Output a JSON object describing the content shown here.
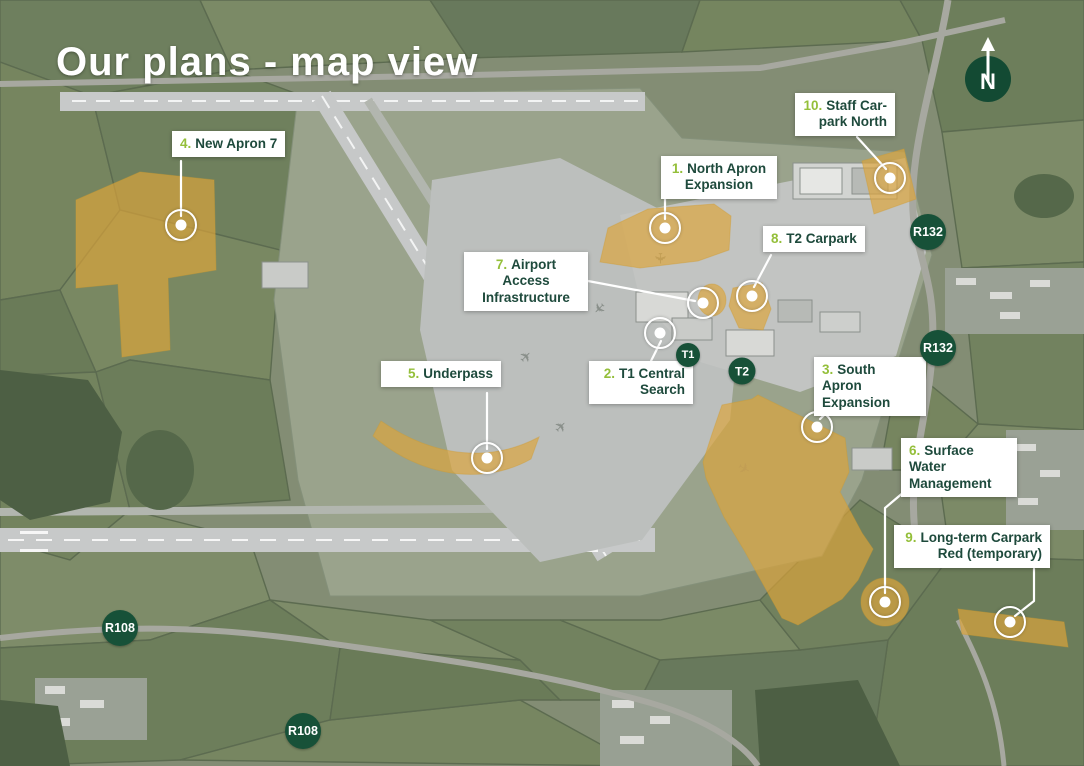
{
  "title": "Our plans - map view",
  "compass": {
    "label": "N"
  },
  "plans": [
    {
      "number": "1.",
      "label": "North Apron Expansion"
    },
    {
      "number": "2.",
      "label": "T1 Central Search"
    },
    {
      "number": "3.",
      "label": "South Apron Expansion"
    },
    {
      "number": "4.",
      "label": "New Apron 7"
    },
    {
      "number": "5.",
      "label": "Underpass"
    },
    {
      "number": "6.",
      "label": "Surface Water Management"
    },
    {
      "number": "7.",
      "label": "Airport Access Infrastructure"
    },
    {
      "number": "8.",
      "label": "T2 Carpark"
    },
    {
      "number": "9.",
      "label": "Long-term Carpark Red (temporary)"
    },
    {
      "number": "10.",
      "label": "Staff Car-park North"
    }
  ],
  "terminal_badges": [
    {
      "label": "T1"
    },
    {
      "label": "T2"
    }
  ],
  "road_badges": [
    {
      "label": "R132"
    },
    {
      "label": "R132"
    },
    {
      "label": "R108"
    },
    {
      "label": "R108"
    }
  ],
  "colors": {
    "highlight_amber": "#dda53b",
    "badge_green": "#175138",
    "compass_green": "#134a33",
    "label_text_green": "#1e4a3c",
    "number_green": "#94bf3a",
    "title_white": "#ffffff"
  }
}
